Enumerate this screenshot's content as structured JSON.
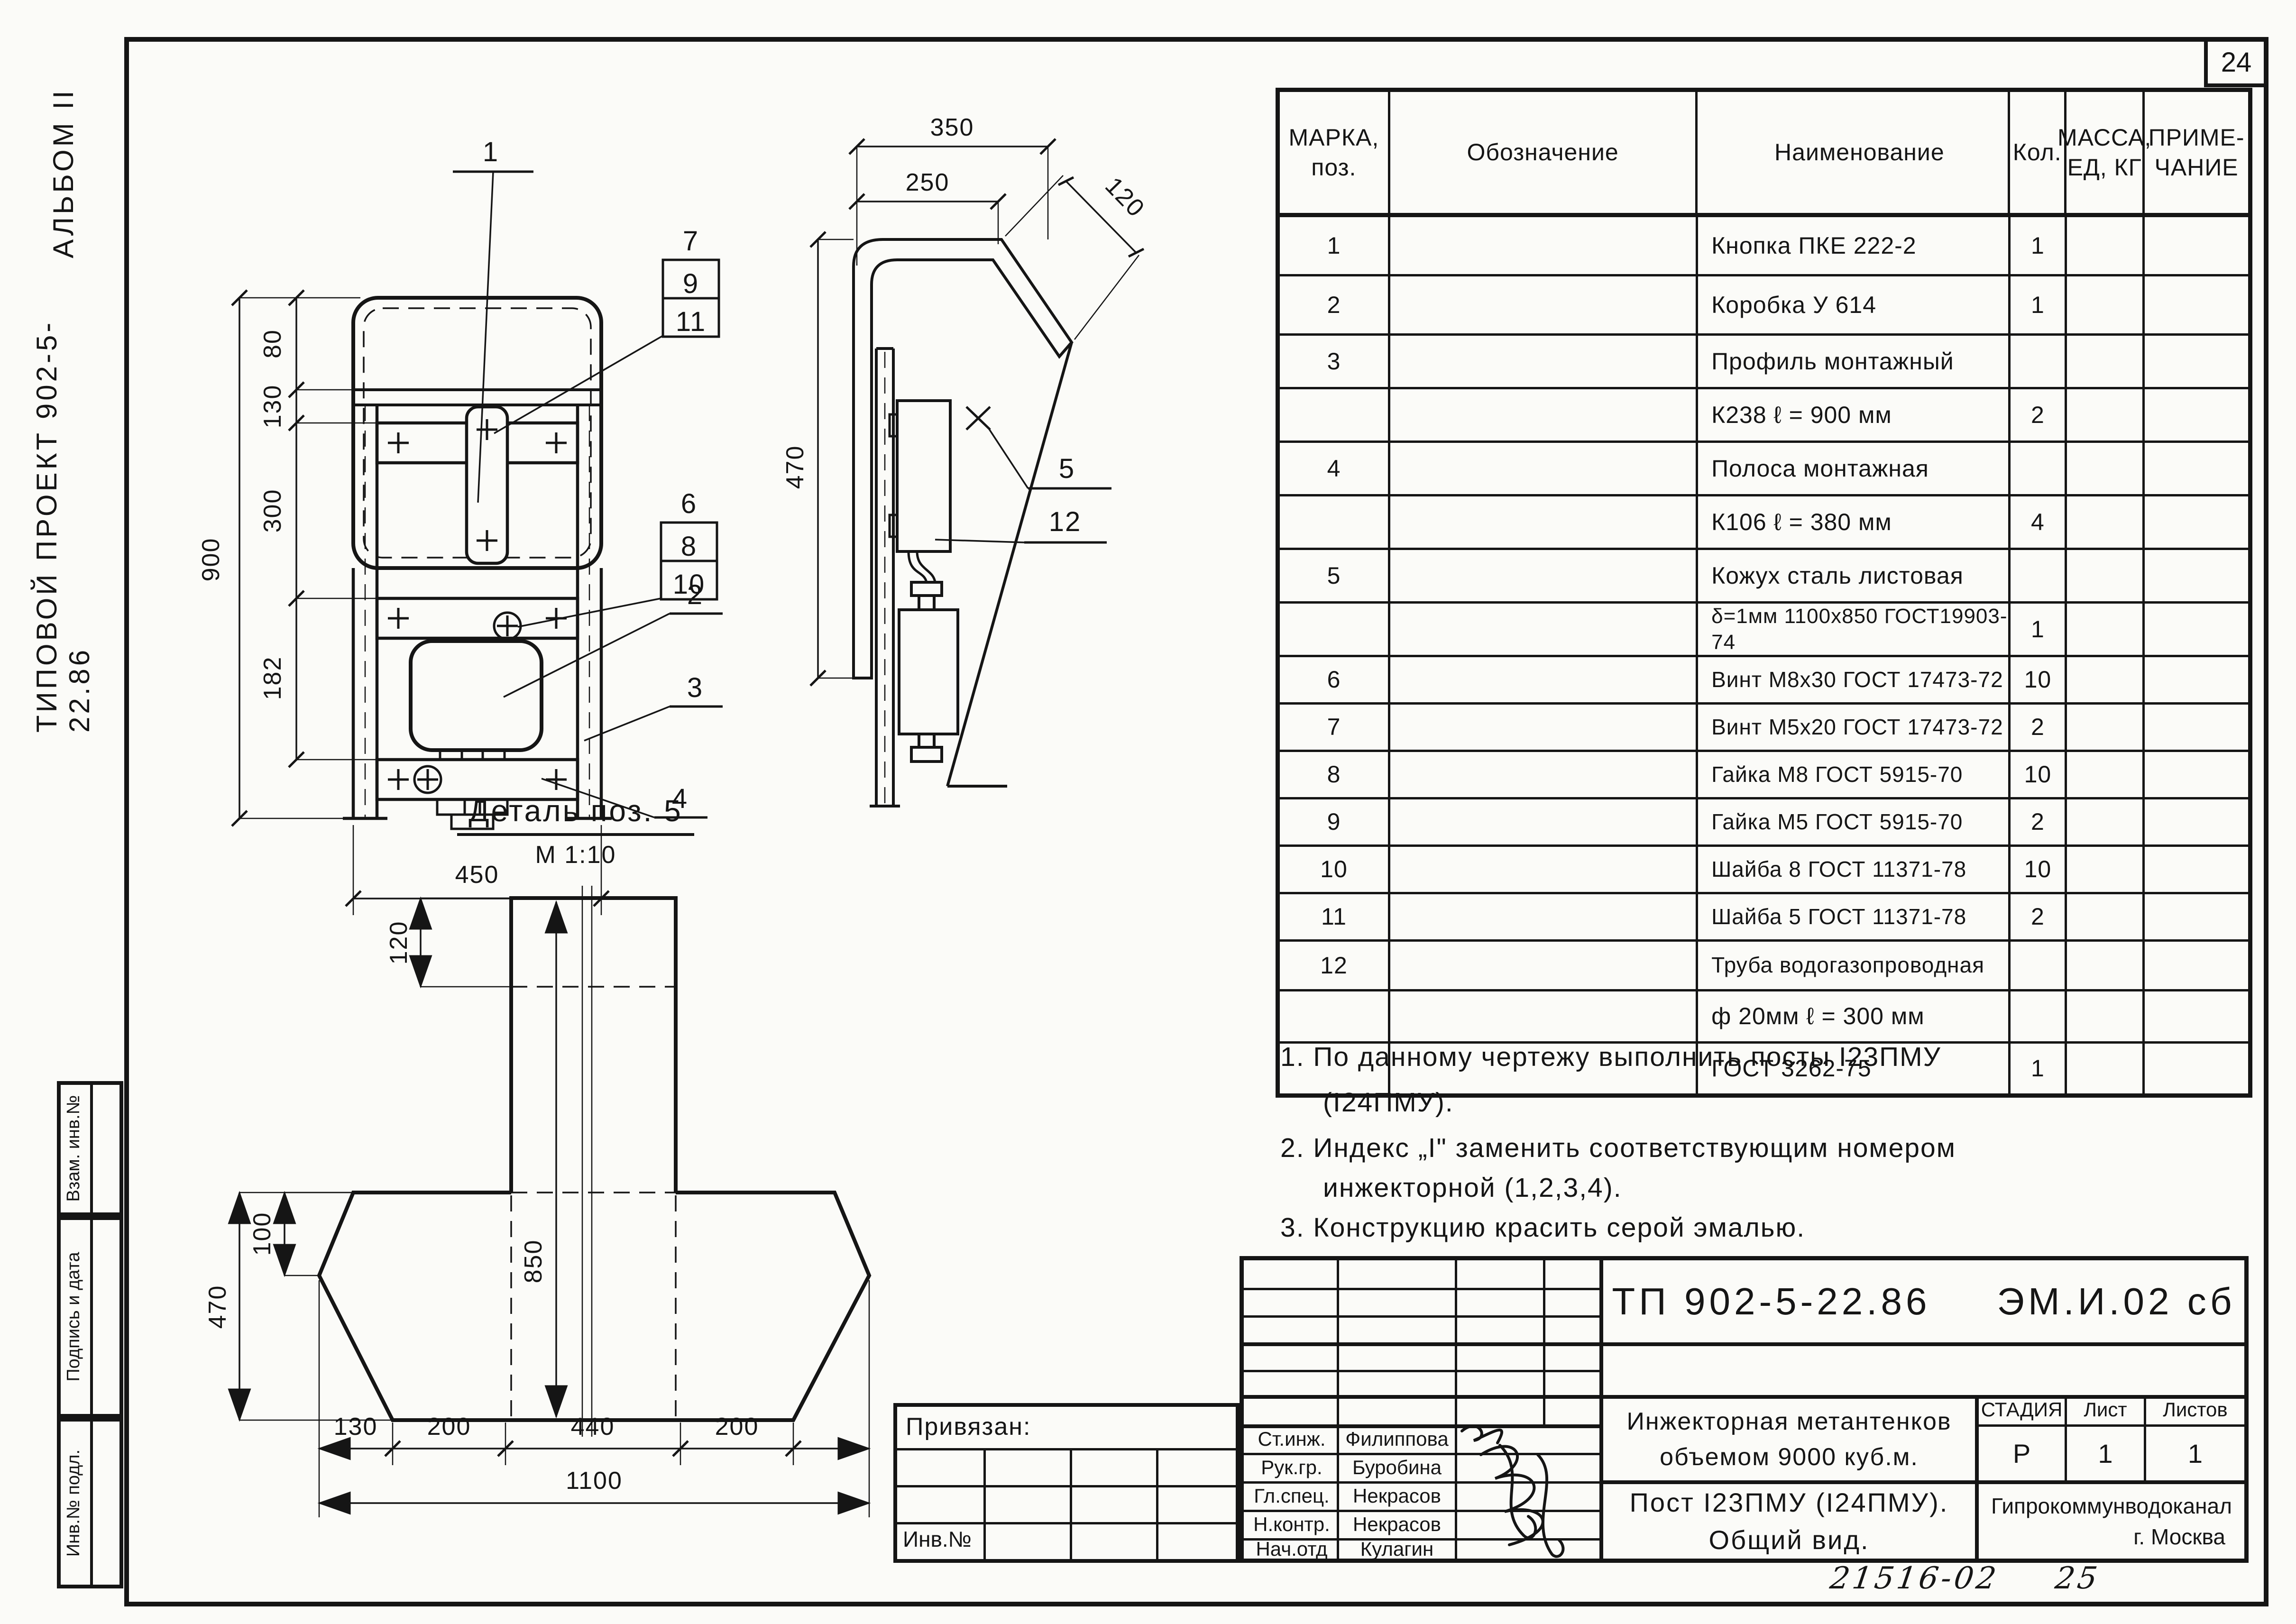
{
  "sheet": {
    "number": "24",
    "archive_number": "21516-02",
    "page_ref": "25"
  },
  "margin_labels": {
    "album": "АЛЬБОМ II",
    "project": "ТИПОВОЙ ПРОЕКТ 902-5-22.86",
    "vzam": "Взам. инв.№",
    "podpis": "Подпись и дата",
    "inv_podl": "Инв.№ подл."
  },
  "front_view": {
    "dims": {
      "h_total": "900",
      "h80": "80",
      "h130": "130",
      "h300": "300",
      "h182": "182",
      "w450": "450"
    },
    "callouts": {
      "c1": "1",
      "c2": "2",
      "c3": "3",
      "c4": "4",
      "s7": "7",
      "s9": "9",
      "s11": "11",
      "s6": "6",
      "s8": "8",
      "s10": "10"
    }
  },
  "side_view": {
    "dims": {
      "w350": "350",
      "w250": "250",
      "d120": "120",
      "h470": "470"
    },
    "callouts": {
      "c5": "5",
      "c12": "12"
    }
  },
  "detail_view": {
    "title": "Деталь поз. 5",
    "scale": "М 1:10",
    "dims": {
      "h120": "120",
      "h850": "850",
      "h100": "100",
      "h470": "470",
      "w130": "130",
      "w200a": "200",
      "w440": "440",
      "w200b": "200",
      "w_total": "1100"
    }
  },
  "parts_table": {
    "headers": {
      "mark": "МАРКА,\nпоз.",
      "designation": "Обозначение",
      "name": "Наименование",
      "qty": "Кол.",
      "mass": "МАССА,\nЕД, КГ",
      "note": "ПРИМЕ-\nЧАНИЕ"
    },
    "rows": [
      {
        "mark": "1",
        "name": "Кнопка   ПКЕ 222-2",
        "qty": "1"
      },
      {
        "mark": "2",
        "name": "Коробка     У 614",
        "qty": "1"
      },
      {
        "mark": "3",
        "name": "Профиль  монтажный",
        "qty": ""
      },
      {
        "mark": "",
        "name": "К238   ℓ = 900 мм",
        "qty": "2"
      },
      {
        "mark": "4",
        "name": "Полоса  монтажная",
        "qty": ""
      },
      {
        "mark": "",
        "name": "К106   ℓ = 380 мм",
        "qty": "4"
      },
      {
        "mark": "5",
        "name": "Кожух   сталь  листовая",
        "qty": ""
      },
      {
        "mark": "",
        "name": "δ=1мм 1100х850 ГОСТ19903-74",
        "qty": "1"
      },
      {
        "mark": "6",
        "name": "Винт М8х30 ГОСТ 17473-72",
        "qty": "10"
      },
      {
        "mark": "7",
        "name": "Винт М5х20 ГОСТ 17473-72",
        "qty": "2"
      },
      {
        "mark": "8",
        "name": "Гайка М8   ГОСТ 5915-70",
        "qty": "10"
      },
      {
        "mark": "9",
        "name": "Гайка М5   ГОСТ 5915-70",
        "qty": "2"
      },
      {
        "mark": "10",
        "name": "Шайба 8   ГОСТ 11371-78",
        "qty": "10"
      },
      {
        "mark": "11",
        "name": "Шайба 5  ГОСТ 11371-78",
        "qty": "2"
      },
      {
        "mark": "12",
        "name": "Труба  водогазопроводная",
        "qty": ""
      },
      {
        "mark": "",
        "name": "ф 20мм    ℓ = 300 мм",
        "qty": ""
      },
      {
        "mark": "",
        "name": "ГОСТ 3262-75",
        "qty": "1"
      }
    ]
  },
  "notes": {
    "n1a": "1. По данному чертежу выполнить посты   I23ПМУ",
    "n1b": "(I24ПМУ).",
    "n2a": "2. Индекс „I\" заменить  соответствующим  номером",
    "n2b": "инжекторной  (1,2,3,4).",
    "n3": "3. Конструкцию  красить  серой  эмалью."
  },
  "stamp": {
    "doc_number": "ТП 902-5-22.86",
    "doc_code": "ЭМ.И.02 сб",
    "attached_label": "Привязан:",
    "inv_label": "Инв.№",
    "people": [
      {
        "role": "Ст.инж.",
        "name": "Филиппова"
      },
      {
        "role": "Рук.гр.",
        "name": "Буробина"
      },
      {
        "role": "Гл.спец.",
        "name": "Некрасов"
      },
      {
        "role": "Н.контр.",
        "name": "Некрасов"
      },
      {
        "role": "Нач.отд",
        "name": "Кулагин"
      }
    ],
    "subject_line1": "Инжекторная метантенков",
    "subject_line2": "объемом   9000   куб.м.",
    "title_line1": "Пост I23ПМУ (I24ПМУ).",
    "title_line2": "Общий вид.",
    "stage_label": "СТАДИЯ",
    "sheet_label": "Лист",
    "sheets_label": "Листов",
    "stage": "Р",
    "sheet": "1",
    "sheets": "1",
    "org_line1": "Гипрокоммунводоканал",
    "org_line2": "г. Москва"
  }
}
